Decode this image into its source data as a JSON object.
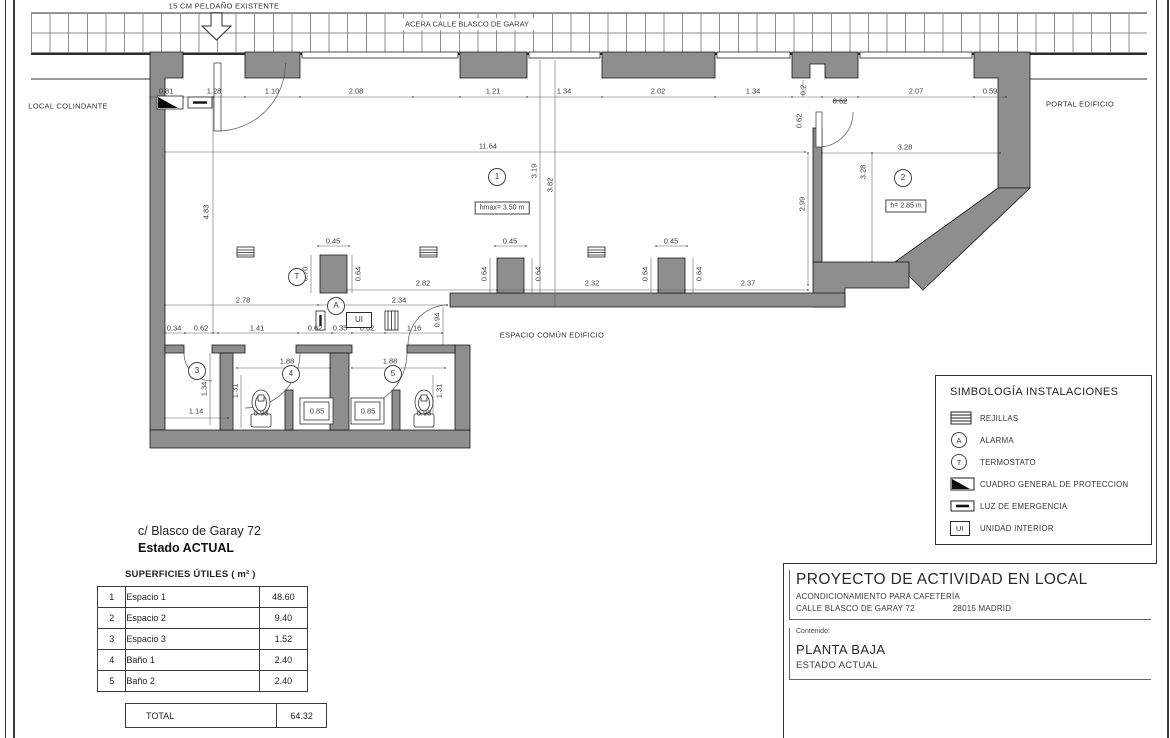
{
  "plan": {
    "labels": [
      {
        "t": "15 CM PELDAÑO EXISTENTE",
        "x": 224,
        "y": 6,
        "k": "n",
        "n": "step-note"
      },
      {
        "t": "ACERA CALLE BLASCO DE GARAY",
        "x": 467,
        "y": 24,
        "k": "nb",
        "n": "sidewalk-label"
      },
      {
        "t": "LOCAL COLINDANTE",
        "x": 68,
        "y": 106,
        "k": "n",
        "n": "adjacent-local-label"
      },
      {
        "t": "PORTAL EDIFICIO",
        "x": 1080,
        "y": 104,
        "k": "n",
        "n": "portal-label"
      },
      {
        "t": "ESPACIO COMÚN EDIFICIO",
        "x": 552,
        "y": 335,
        "k": "n",
        "n": "common-space-label"
      },
      {
        "t": "0.81",
        "x": 166,
        "y": 91
      },
      {
        "t": "1.28",
        "x": 214,
        "y": 91
      },
      {
        "t": "1.10",
        "x": 272,
        "y": 91
      },
      {
        "t": "2.08",
        "x": 356,
        "y": 91
      },
      {
        "t": "1.21",
        "x": 493,
        "y": 91
      },
      {
        "t": "1.34",
        "x": 564,
        "y": 91
      },
      {
        "t": "2.02",
        "x": 658,
        "y": 91
      },
      {
        "t": "1.34",
        "x": 753,
        "y": 91
      },
      {
        "t": "0.62",
        "x": 840,
        "y": 101,
        "k": "s"
      },
      {
        "t": "2.07",
        "x": 916,
        "y": 91
      },
      {
        "t": "0.59",
        "x": 990,
        "y": 91
      },
      {
        "t": "0.2",
        "x": 803,
        "y": 90,
        "k": "v"
      },
      {
        "t": "0.62",
        "x": 799,
        "y": 121,
        "k": "v"
      },
      {
        "t": "11.64",
        "x": 488,
        "y": 146
      },
      {
        "t": "3.19",
        "x": 534,
        "y": 171,
        "k": "v"
      },
      {
        "t": "3.82",
        "x": 550,
        "y": 185,
        "k": "v"
      },
      {
        "t": "4.83",
        "x": 206,
        "y": 212,
        "k": "v"
      },
      {
        "t": "2.78",
        "x": 243,
        "y": 300
      },
      {
        "t": "2.34",
        "x": 399,
        "y": 300
      },
      {
        "t": "2.82",
        "x": 423,
        "y": 283
      },
      {
        "t": "2.32",
        "x": 592,
        "y": 283
      },
      {
        "t": "2.37",
        "x": 748,
        "y": 283
      },
      {
        "t": "0.70",
        "x": 305,
        "y": 274,
        "k": "v"
      },
      {
        "t": "0.45",
        "x": 333,
        "y": 241
      },
      {
        "t": "0.64",
        "x": 358,
        "y": 274,
        "k": "v"
      },
      {
        "t": "0.45",
        "x": 510,
        "y": 241
      },
      {
        "t": "0.64",
        "x": 484,
        "y": 274,
        "k": "v"
      },
      {
        "t": "0.64",
        "x": 538,
        "y": 274,
        "k": "v"
      },
      {
        "t": "0.45",
        "x": 671,
        "y": 241
      },
      {
        "t": "0.64",
        "x": 645,
        "y": 274,
        "k": "v"
      },
      {
        "t": "0.64",
        "x": 699,
        "y": 274,
        "k": "v"
      },
      {
        "t": "0.94",
        "x": 437,
        "y": 320,
        "k": "v"
      },
      {
        "t": "2.99",
        "x": 802,
        "y": 204,
        "k": "v"
      },
      {
        "t": "3.28",
        "x": 905,
        "y": 147
      },
      {
        "t": "3.28",
        "x": 863,
        "y": 172,
        "k": "v"
      },
      {
        "t": "0.34",
        "x": 174,
        "y": 328
      },
      {
        "t": "0.62",
        "x": 201,
        "y": 328
      },
      {
        "t": "1.41",
        "x": 257,
        "y": 328
      },
      {
        "t": "0.62",
        "x": 315,
        "y": 328
      },
      {
        "t": "0.35",
        "x": 340,
        "y": 328
      },
      {
        "t": "0.62",
        "x": 367,
        "y": 328
      },
      {
        "t": "1.16",
        "x": 414,
        "y": 328
      },
      {
        "t": "1.88",
        "x": 287,
        "y": 361
      },
      {
        "t": "1.88",
        "x": 390,
        "y": 361
      },
      {
        "t": "1.31",
        "x": 235,
        "y": 391,
        "k": "v"
      },
      {
        "t": "1.31",
        "x": 439,
        "y": 391,
        "k": "v"
      },
      {
        "t": "1.34",
        "x": 204,
        "y": 389,
        "k": "v"
      },
      {
        "t": "1.14",
        "x": 196,
        "y": 411
      },
      {
        "t": "0.93",
        "x": 261,
        "y": 413
      },
      {
        "t": "0.93",
        "x": 424,
        "y": 413
      },
      {
        "t": "0.85",
        "x": 317,
        "y": 411
      },
      {
        "t": "0.85",
        "x": 368,
        "y": 411
      },
      {
        "t": "1",
        "x": 497,
        "y": 177,
        "k": "c",
        "n": "room-marker-espacio-1"
      },
      {
        "t": "2",
        "x": 903,
        "y": 178,
        "k": "c",
        "n": "room-marker-espacio-2"
      },
      {
        "t": "3",
        "x": 197,
        "y": 371,
        "k": "c",
        "n": "room-marker-espacio-3"
      },
      {
        "t": "4",
        "x": 291,
        "y": 374,
        "k": "c",
        "n": "room-marker-bano-1"
      },
      {
        "t": "5",
        "x": 393,
        "y": 374,
        "k": "c",
        "n": "room-marker-bano-2"
      },
      {
        "t": "T",
        "x": 297,
        "y": 277,
        "k": "c",
        "n": "termostato-symbol"
      },
      {
        "t": "A",
        "x": 336,
        "y": 306,
        "k": "c",
        "n": "alarma-symbol"
      },
      {
        "t": "hmax= 3.50 m",
        "x": 502,
        "y": 208,
        "k": "b",
        "n": "height-note-espacio-1"
      },
      {
        "t": "h= 2.85 m",
        "x": 906,
        "y": 206,
        "k": "b",
        "n": "height-note-espacio-2"
      },
      {
        "t": "UI",
        "x": 359,
        "y": 320,
        "k": "bu",
        "n": "unidad-interior-symbol"
      }
    ]
  },
  "legend": {
    "title": "SIMBOLOGÍA INSTALACIONES",
    "items": [
      {
        "symbol": "rejilla",
        "label": "REJILLAS"
      },
      {
        "symbol": "circle",
        "letter": "A",
        "label": "ALARMA"
      },
      {
        "symbol": "circle",
        "letter": "T",
        "label": "TERMOSTATO"
      },
      {
        "symbol": "cuadro",
        "label": "CUADRO GENERAL DE PROTECCION"
      },
      {
        "symbol": "luz",
        "label": "LUZ DE EMERGENCIA"
      },
      {
        "symbol": "ui",
        "letter": "UI",
        "label": "UNIDAD INTERIOR"
      }
    ]
  },
  "address": {
    "line1": "c/ Blasco de Garay 72",
    "line2": "Estado ACTUAL"
  },
  "surfaces": {
    "title": "SUPERFICIES ÚTILES ( m² )",
    "rows": [
      {
        "num": "1",
        "name": "Espacio 1",
        "value": "48.60"
      },
      {
        "num": "2",
        "name": "Espacio 2",
        "value": "9.40"
      },
      {
        "num": "3",
        "name": "Espacio 3",
        "value": "1.52"
      },
      {
        "num": "4",
        "name": "Baño 1",
        "value": "2.40"
      },
      {
        "num": "5",
        "name": "Baño 2",
        "value": "2.40"
      }
    ],
    "total_label": "TOTAL",
    "total_value": "64.32"
  },
  "title_block": {
    "title": "PROYECTO DE ACTIVIDAD EN LOCAL",
    "subtitle": "ACONDICIONAMIENTO PARA CAFETERÍA",
    "address": "CALLE BLASCO DE GARAY 72",
    "city": "28015 MADRID",
    "contents_label": "Contenido:",
    "content_line1": "PLANTA BAJA",
    "content_line2": "ESTADO ACTUAL"
  }
}
